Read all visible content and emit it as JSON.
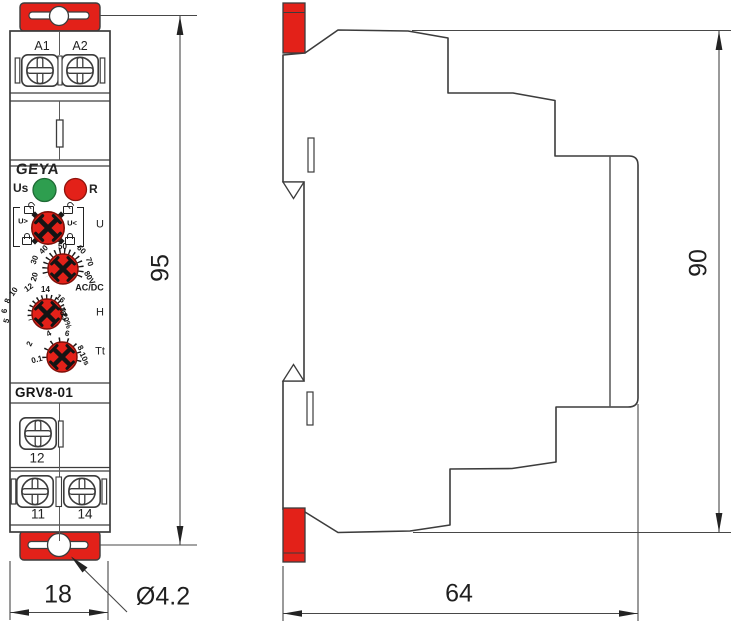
{
  "front_view": {
    "brand_logo": "GEYA",
    "model": "GRV8-01",
    "terminals_top": [
      "A1",
      "A2"
    ],
    "terminals_bottom_row1": [
      "12"
    ],
    "terminals_bottom_row2": [
      "11",
      "14"
    ],
    "led_us_label": "Us",
    "led_r_label": "R",
    "dial_u": {
      "left_marking": "U>",
      "right_marking": "U<",
      "label": "U"
    },
    "dial_voltage": {
      "scale": [
        "20",
        "30",
        "40",
        "50",
        "60",
        "70",
        "80V"
      ],
      "label": "AC/DC"
    },
    "dial_h": {
      "scale": [
        "5",
        "6",
        "8",
        "10",
        "12",
        "14",
        "16",
        "18",
        "20%"
      ],
      "label": "H"
    },
    "dial_t": {
      "scale": [
        "0.1",
        "2",
        "4",
        "6",
        "8",
        "10s"
      ],
      "label": "Tt"
    }
  },
  "dimensions": {
    "width": "18",
    "height": "95",
    "side_height": "90",
    "depth": "64",
    "hole_diameter": "Ø4.2"
  },
  "colors": {
    "accent_red": "#e32119",
    "led_green": "#2e9e4f",
    "line": "#3c3c3c"
  }
}
